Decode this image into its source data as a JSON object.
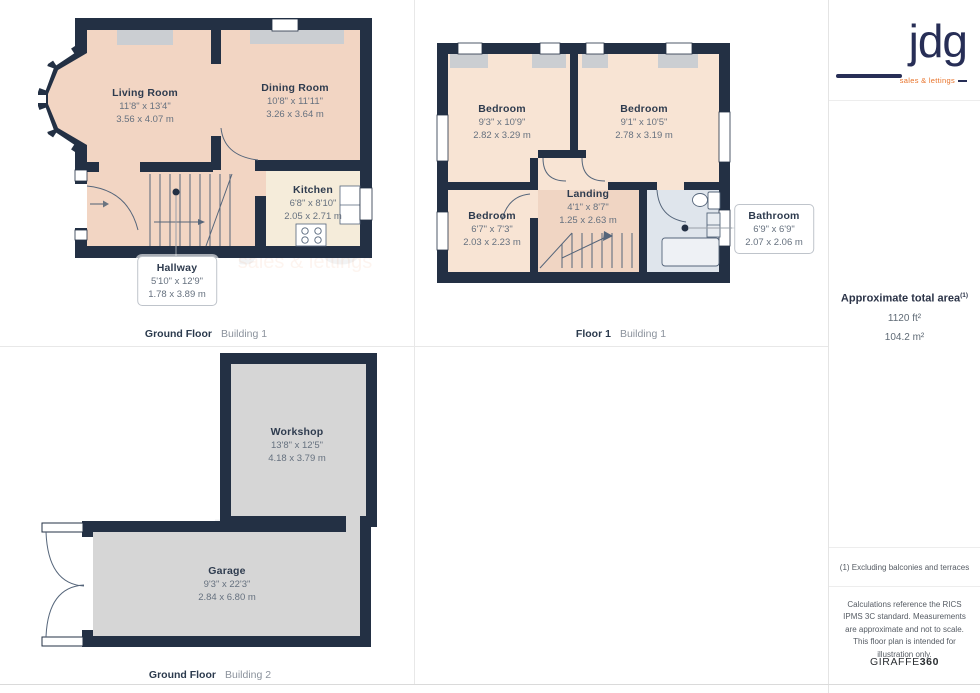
{
  "brand": {
    "logo_text": "jdg",
    "logo_tagline": "sales & lettings",
    "navy": "#272e56",
    "orange": "#e8732a"
  },
  "colors": {
    "wall": "#233044",
    "room_peach": "#f2d5c3",
    "room_peach_light": "#f8e4d4",
    "kitchen_cream": "#f5ecda",
    "bathroom_blue": "#dfe5ec",
    "floor_grey": "#d6d6d6",
    "alcove_grey": "#cbced2"
  },
  "plans": {
    "ground_floor_b1": {
      "floor_label": "Ground Floor",
      "building_label": "Building 1",
      "rooms": {
        "living_room": {
          "name": "Living Room",
          "dims_ft": "11'8\" x 13'4\"",
          "dims_m": "3.56 x 4.07 m"
        },
        "dining_room": {
          "name": "Dining Room",
          "dims_ft": "10'8\" x 11'11\"",
          "dims_m": "3.26 x 3.64 m"
        },
        "kitchen": {
          "name": "Kitchen",
          "dims_ft": "6'8\" x 8'10\"",
          "dims_m": "2.05 x 2.71 m"
        },
        "hallway": {
          "name": "Hallway",
          "dims_ft": "5'10\" x 12'9\"",
          "dims_m": "1.78 x 3.89 m"
        }
      }
    },
    "floor_1_b1": {
      "floor_label": "Floor 1",
      "building_label": "Building 1",
      "rooms": {
        "bedroom_1": {
          "name": "Bedroom",
          "dims_ft": "9'3\" x 10'9\"",
          "dims_m": "2.82 x 3.29 m"
        },
        "bedroom_2": {
          "name": "Bedroom",
          "dims_ft": "9'1\" x 10'5\"",
          "dims_m": "2.78 x 3.19 m"
        },
        "bedroom_3": {
          "name": "Bedroom",
          "dims_ft": "6'7\" x 7'3\"",
          "dims_m": "2.03 x 2.23 m"
        },
        "landing": {
          "name": "Landing",
          "dims_ft": "4'1\" x 8'7\"",
          "dims_m": "1.25 x 2.63 m"
        },
        "bathroom": {
          "name": "Bathroom",
          "dims_ft": "6'9\" x 6'9\"",
          "dims_m": "2.07 x 2.06 m"
        }
      }
    },
    "ground_floor_b2": {
      "floor_label": "Ground Floor",
      "building_label": "Building 2",
      "rooms": {
        "workshop": {
          "name": "Workshop",
          "dims_ft": "13'8\" x 12'5\"",
          "dims_m": "4.18 x 3.79 m"
        },
        "garage": {
          "name": "Garage",
          "dims_ft": "9'3\" x 22'3\"",
          "dims_m": "2.84 x 6.80 m"
        }
      }
    }
  },
  "sidebar": {
    "area_title": "Approximate total area",
    "area_footnote_mark": "(1)",
    "area_ft": "1120 ft²",
    "area_m": "104.2 m²",
    "footnote": "(1) Excluding balconies and terraces",
    "disclaimer": "Calculations reference the RICS IPMS 3C standard. Measurements are approximate and not to scale. This floor plan is intended for illustration only.",
    "provider_name": "GIRAFFE",
    "provider_suffix": "360"
  }
}
